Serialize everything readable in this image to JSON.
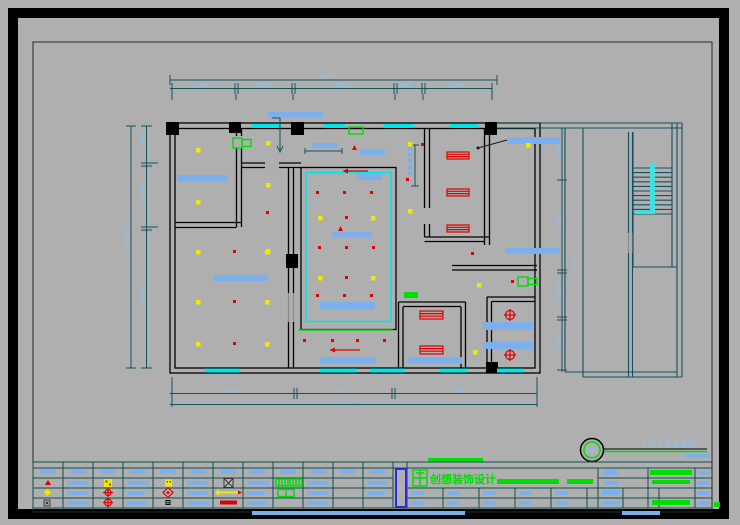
{
  "annotation": {
    "plan_title": "十层天花布置图",
    "detail_label": "详图"
  },
  "title_block": {
    "company": "创想装饰设计"
  },
  "dimensions": {
    "top": {
      "overall": "10650",
      "chain": [
        "2160",
        "1900",
        "3360",
        "950",
        "2280"
      ]
    },
    "left": {
      "overall": "8140",
      "chain": [
        "1240",
        "2140",
        "4760"
      ]
    },
    "bottom": {
      "overall": "12170",
      "chain": [
        "4100",
        "3270",
        "4800"
      ]
    },
    "right": {
      "overall": "8150",
      "chain": [
        "1740",
        "3100",
        "1590",
        "1720"
      ]
    }
  },
  "colors": {
    "background": "#afafaf",
    "walls": "#000000",
    "wing_walls": "#15505f",
    "windows_cyan": "#00e5e5",
    "fixture_blue": "#7cb0ec",
    "dim_text_blue": "#8fc1f0",
    "lamp_yellow": "#f0e800",
    "symbol_red": "#e00000",
    "symbol_green": "#00dd00",
    "table_lines": "#0b4f4f",
    "titleblock_accent": "#2a2ae0"
  }
}
